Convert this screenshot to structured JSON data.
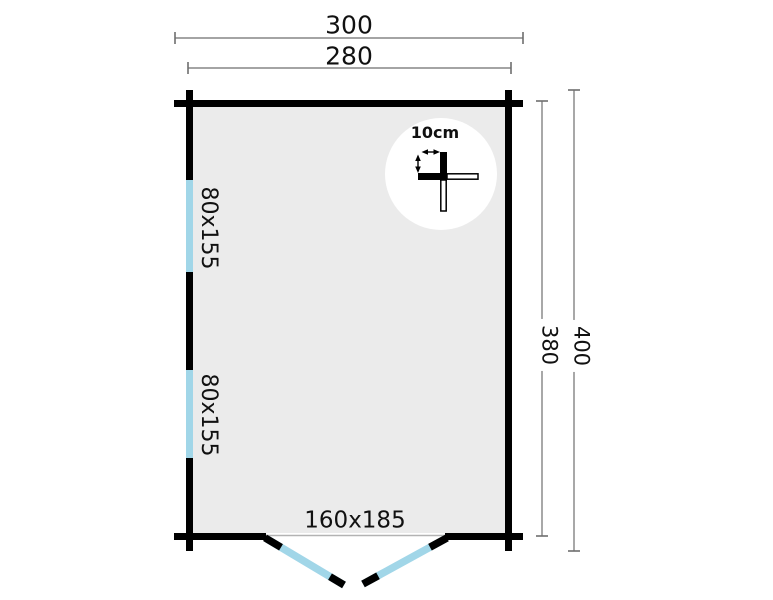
{
  "colors": {
    "wall": "#000000",
    "interior_fill": "#ebebeb",
    "opening_blue": "#a1d6e8",
    "dimension_line": "#6e6e6e",
    "threshold": "#b3b3b3",
    "text": "#111111",
    "detail_circle": "#ffffff"
  },
  "floor_plan": {
    "dimensions": {
      "outer_width": "300",
      "inner_width": "280",
      "inner_depth": "380",
      "outer_depth": "400"
    },
    "windows": [
      {
        "size": "80x155"
      },
      {
        "size": "80x155"
      }
    ],
    "door": {
      "size": "160x185"
    },
    "wall_detail": {
      "thickness": "10cm"
    }
  }
}
